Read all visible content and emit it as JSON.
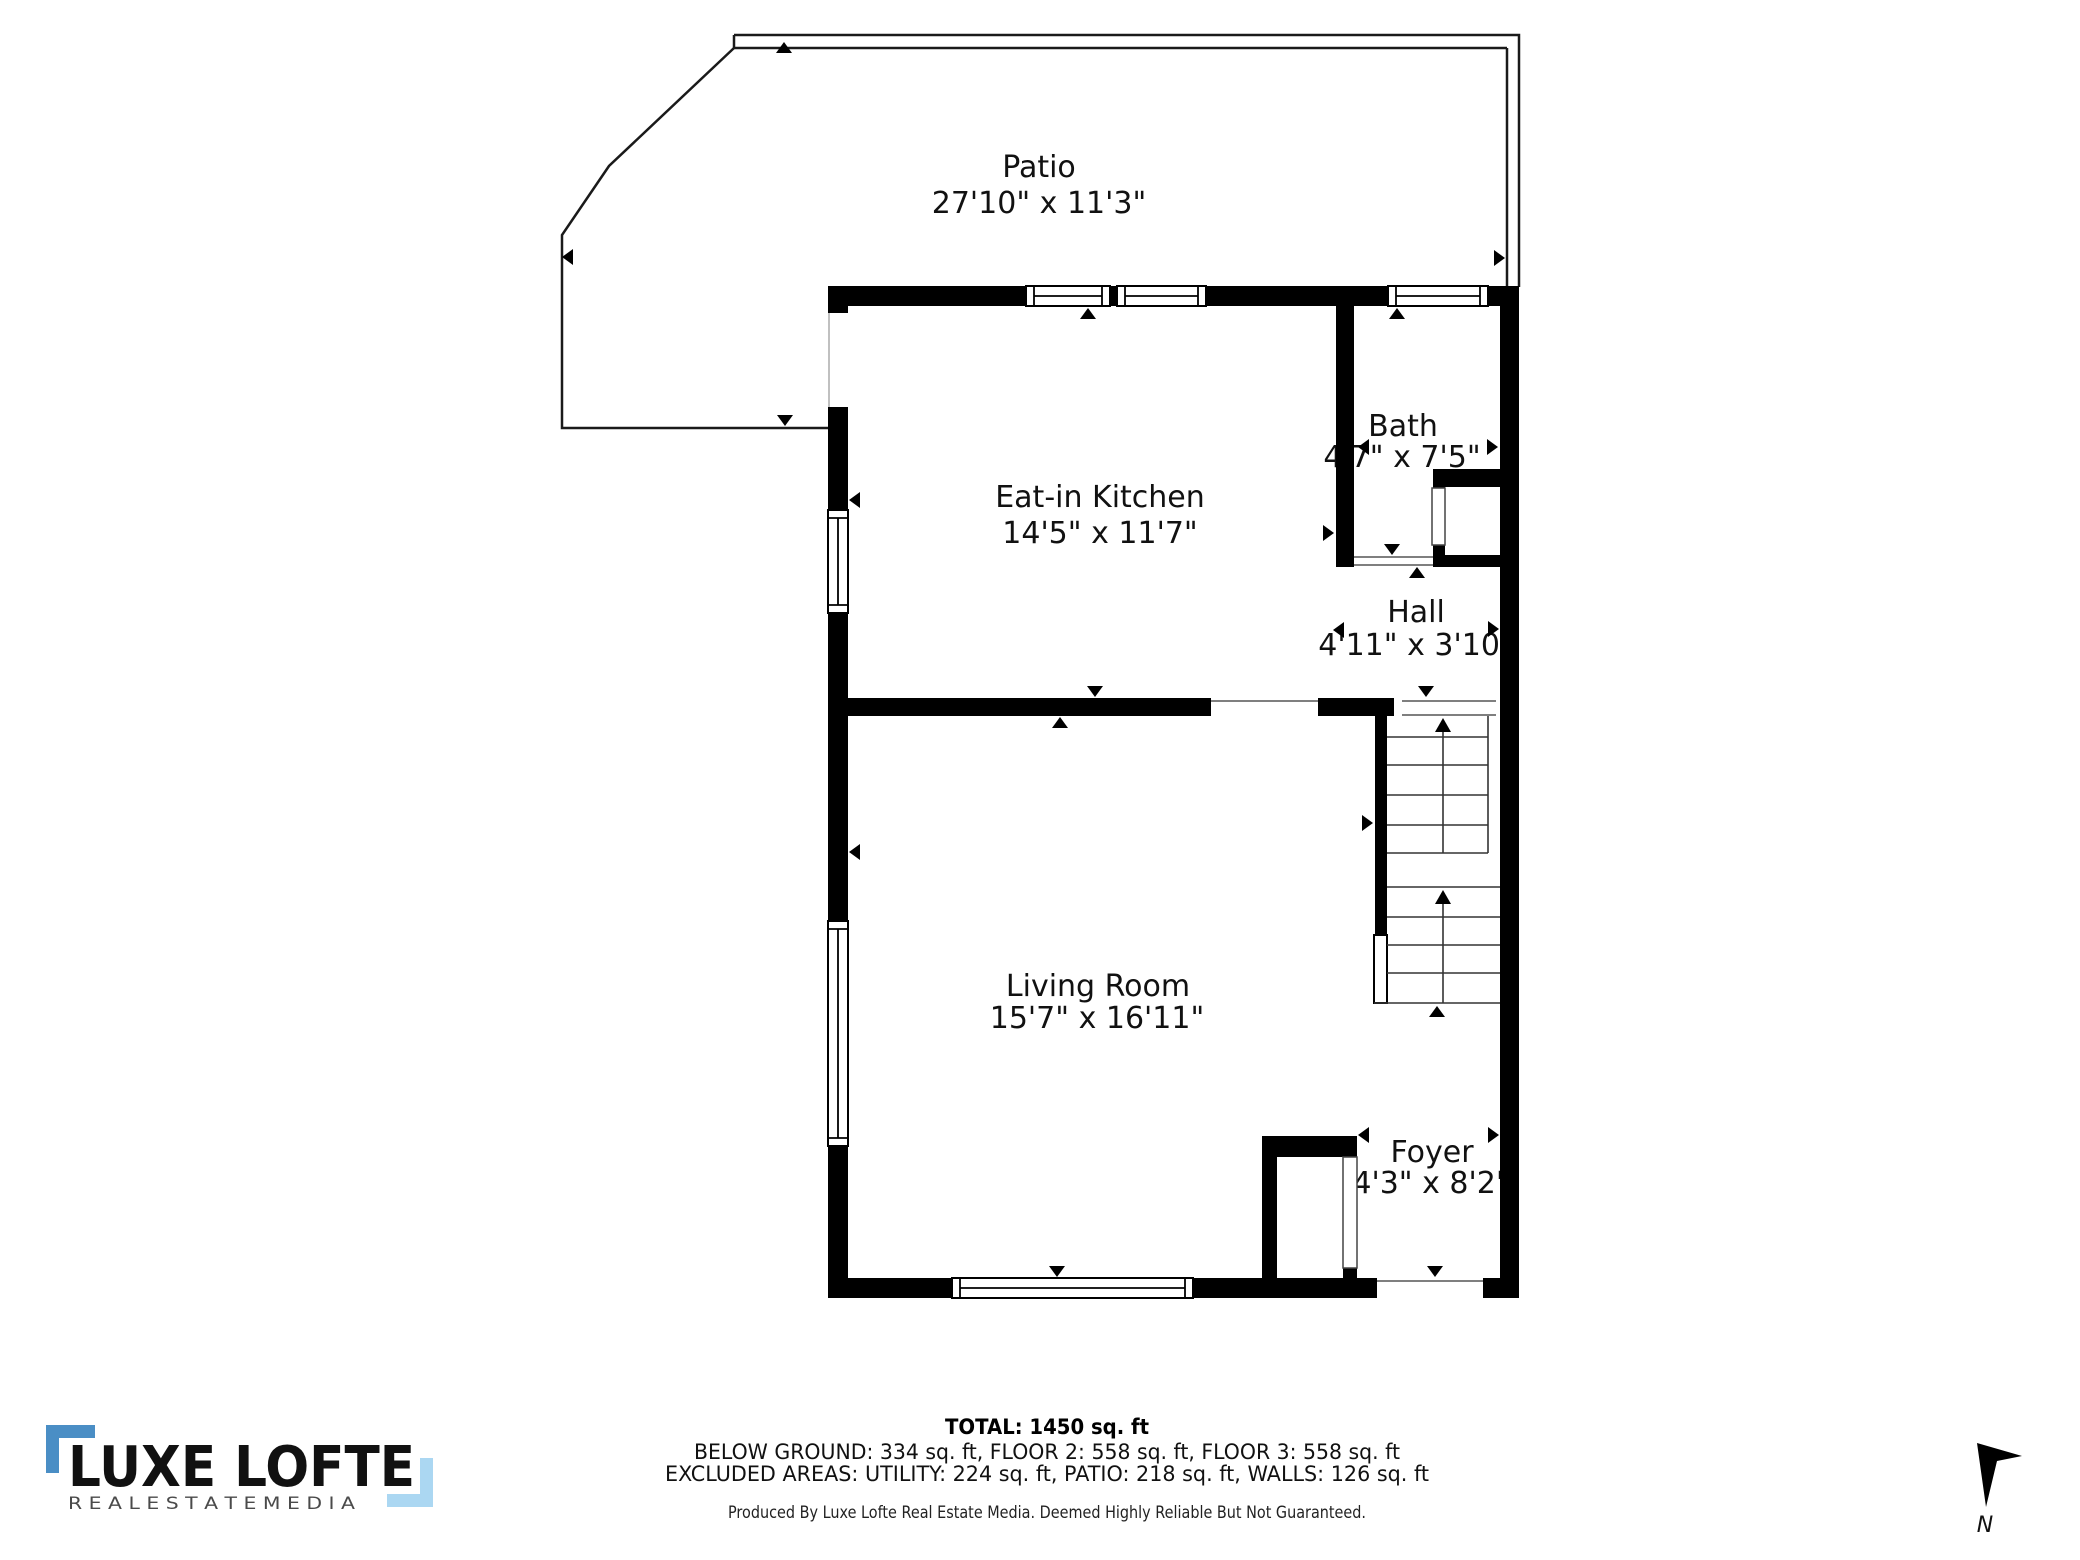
{
  "plan": {
    "rooms": [
      {
        "name": "Patio",
        "dims": "27'10\" x 11'3\""
      },
      {
        "name": "Eat-in Kitchen",
        "dims": "14'5\" x 11'7\""
      },
      {
        "name": "Bath",
        "dims": "4'7\" x 7'5\""
      },
      {
        "name": "Hall",
        "dims": "4'11\" x 3'10\""
      },
      {
        "name": "Living Room",
        "dims": "15'7\" x 16'11\""
      },
      {
        "name": "Foyer",
        "dims": "4'3\" x 8'2\""
      }
    ]
  },
  "footer": {
    "total": "TOTAL: 1450 sq. ft",
    "floors": "BELOW GROUND: 334 sq. ft, FLOOR 2: 558 sq. ft, FLOOR 3: 558 sq. ft",
    "excluded": "EXCLUDED AREAS: UTILITY: 224 sq. ft, PATIO: 218 sq. ft, WALLS: 126 sq. ft",
    "disclaimer": "Produced By Luxe Lofte Real Estate Media. Deemed Highly Reliable But Not Guaranteed."
  },
  "logo": {
    "brand": "LUXE LOFTE",
    "tagline": "R E A L   E S T A T E   M E D I A",
    "bracket_dark": "#4a8ec5",
    "bracket_light": "#abd7f2"
  },
  "compass": {
    "label": "N"
  }
}
